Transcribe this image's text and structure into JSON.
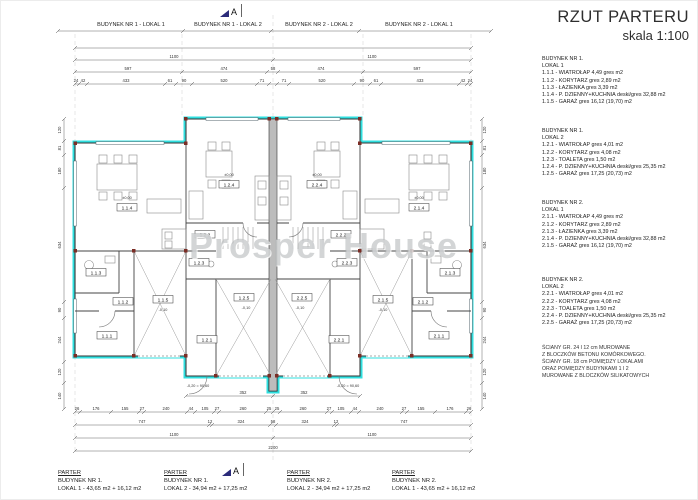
{
  "title": {
    "main": "RZUT PARTERU",
    "scale": "skala 1:100"
  },
  "section_marker": "A",
  "watermark": "Prosper House",
  "top_labels": [
    "BUDYNEK NR 1 - LOKAL 1",
    "BUDYNEK NR 1 - LOKAL 2",
    "BUDYNEK NR 2 - LOKAL 2",
    "BUDYNEK NR 2 - LOKAL 1"
  ],
  "bottom_labels": [
    {
      "title": "PARTER",
      "building": "BUDYNEK NR 1.",
      "area": "LOKAL 1 - 43,65 m2 + 16,12 m2"
    },
    {
      "title": "PARTER",
      "building": "BUDYNEK NR 1.",
      "area": "LOKAL 2 - 34,94 m2 + 17,25 m2"
    },
    {
      "title": "PARTER",
      "building": "BUDYNEK NR 2.",
      "area": "LOKAL 2 - 34,94 m2 + 17,25 m2"
    },
    {
      "title": "PARTER",
      "building": "BUDYNEK NR 2.",
      "area": "LOKAL 1 - 43,65 m2 + 16,12 m2"
    }
  ],
  "legend": {
    "blocks": [
      {
        "building": "BUDYNEK NR 1.",
        "lokal": "LOKAL 1",
        "items": [
          "1.1.1 - WIATROŁAP 4,49 gres m2",
          "1.1.2 - KORYTARZ gres 2,89 m2",
          "1.1.3 - ŁAZIENKA gres 3,39 m2",
          "1.1.4 - P. DZIENNY+KUCHNIA deski/gres 32,88 m2",
          "1.1.5 - GARAŻ gres 16,12 (19,70) m2"
        ]
      },
      {
        "building": "BUDYNEK NR 1.",
        "lokal": "LOKAL 2",
        "items": [
          "1.2.1 - WIATROŁAP gres 4,01 m2",
          "1.2.2 - KORYTARZ gres 4,08 m2",
          "1.2.3 - TOALETA gres 1,50 m2",
          "1.2.4 - P. DZIENNY+KUCHNIA deski/gres 25,35 m2",
          "1.2.5 - GARAŻ gres 17,25 (20,73) m2"
        ]
      },
      {
        "building": "BUDYNEK NR 2.",
        "lokal": "LOKAL 1",
        "items": [
          "2.1.1 - WIATROŁAP 4,49 gres m2",
          "2.1.2 - KORYTARZ gres 2,89 m2",
          "2.1.3 - ŁAZIENKA gres 3,39 m2",
          "2.1.4 - P. DZIENNY+KUCHNIA deski/gres 32,88 m2",
          "2.1.5 - GARAŻ gres 16,12 (19,70) m2"
        ]
      },
      {
        "building": "BUDYNEK NR 2.",
        "lokal": "LOKAL 2",
        "items": [
          "2.2.1 - WIATROŁAP gres 4,01 m2",
          "2.2.2 - KORYTARZ gres 4,08 m2",
          "2.2.3 - TOALETA gres 1,50 m2",
          "2.2.4 - P. DZIENNY+KUCHNIA deski/gres 25,35 m2",
          "2.2.5 - GARAŻ gres 17,25 (20,73) m2"
        ]
      }
    ],
    "note": [
      "ŚCIANY GR. 24 I 12 cm MUROWANE",
      "Z BLOCZKÓW BETONU KOMÓRKOWEGO.",
      "ŚCIANY GR. 18 cm POMIĘDZY LOKALAMI",
      "ORAZ POMIĘDZY BUDYNKAMI 1 I 2",
      "MUROWANE Z BLOCZKÓW SILIKATOWYCH"
    ]
  },
  "plan": {
    "colors": {
      "insulation": "#2fdfdf",
      "marker": "#7b2d25",
      "section": "#2b2b7a"
    },
    "rooms": [
      {
        "tr": "translate(126,208)",
        "t": "1.1.4"
      },
      {
        "tr": "translate(228,185)",
        "t": "1.2.4"
      },
      {
        "tr": "translate(316,185)",
        "t": "2.2.4"
      },
      {
        "tr": "translate(418,208)",
        "t": "2.1.4"
      },
      {
        "tr": "translate(95,273)",
        "t": "1.1.3"
      },
      {
        "tr": "translate(122,302)",
        "t": "1.1.2"
      },
      {
        "tr": "translate(106,336)",
        "t": "1.1.1"
      },
      {
        "tr": "translate(162,300)",
        "t": "1.1.5"
      },
      {
        "tr": "translate(204,235)",
        "t": "1.2.2"
      },
      {
        "tr": "translate(198,263)",
        "t": "1.2.3"
      },
      {
        "tr": "translate(243,298)",
        "t": "1.2.5"
      },
      {
        "tr": "translate(206,340)",
        "t": "1.2.1"
      },
      {
        "tr": "translate(340,235)",
        "t": "2.2.2"
      },
      {
        "tr": "translate(346,263)",
        "t": "2.2.3"
      },
      {
        "tr": "translate(301,298)",
        "t": "2.2.5"
      },
      {
        "tr": "translate(338,340)",
        "t": "2.2.1"
      },
      {
        "tr": "translate(449,273)",
        "t": "2.1.3"
      },
      {
        "tr": "translate(422,302)",
        "t": "2.1.2"
      },
      {
        "tr": "translate(438,336)",
        "t": "2.1.1"
      },
      {
        "tr": "translate(382,300)",
        "t": "2.1.5"
      }
    ],
    "levels": [
      {
        "tr": "translate(126,198)",
        "t": "±0,00"
      },
      {
        "tr": "translate(228,175)",
        "t": "±0,00"
      },
      {
        "tr": "translate(316,175)",
        "t": "±0,00"
      },
      {
        "tr": "translate(418,198)",
        "t": "±0,00"
      },
      {
        "tr": "translate(162,310)",
        "t": "-0,10"
      },
      {
        "tr": "translate(245,308)",
        "t": "-0,10"
      },
      {
        "tr": "translate(299,308)",
        "t": "-0,10"
      },
      {
        "tr": "translate(382,310)",
        "t": "-0,10"
      },
      {
        "tr": "translate(197,386)",
        "t": "-0,20 = 90,60"
      },
      {
        "tr": "translate(347,386)",
        "t": "-0,20 = 90,60"
      }
    ],
    "dims": {
      "top_total": [
        {
          "x": 272,
          "t": "2200"
        }
      ],
      "top_halves": [
        {
          "x": 173,
          "t": "1100"
        },
        {
          "x": 371,
          "t": "1100"
        }
      ],
      "top_seg": [
        {
          "x": 127,
          "t": "597"
        },
        {
          "x": 223,
          "t": "474"
        },
        {
          "x": 272,
          "t": "58"
        },
        {
          "x": 320,
          "t": "474"
        },
        {
          "x": 416,
          "t": "597"
        }
      ],
      "top_detail": [
        {
          "x": 75,
          "t": "24"
        },
        {
          "x": 82,
          "t": "42"
        },
        {
          "x": 125,
          "t": "433"
        },
        {
          "x": 169,
          "t": "61"
        },
        {
          "x": 183,
          "t": "90"
        },
        {
          "x": 223,
          "t": "520"
        },
        {
          "x": 261,
          "t": "71"
        },
        {
          "x": 283,
          "t": "71"
        },
        {
          "x": 321,
          "t": "520"
        },
        {
          "x": 361,
          "t": "90"
        },
        {
          "x": 375,
          "t": "61"
        },
        {
          "x": 419,
          "t": "433"
        },
        {
          "x": 462,
          "t": "42"
        },
        {
          "x": 469,
          "t": "24"
        }
      ],
      "bottom_352": [
        {
          "x": 242,
          "t": "352"
        },
        {
          "x": 303,
          "t": "352"
        }
      ],
      "bottom_detail": [
        {
          "x": 76,
          "t": "26"
        },
        {
          "x": 95,
          "t": "176"
        },
        {
          "x": 124,
          "t": "155"
        },
        {
          "x": 141,
          "t": "27"
        },
        {
          "x": 165,
          "t": "240"
        },
        {
          "x": 190,
          "t": "44"
        },
        {
          "x": 204,
          "t": "105"
        },
        {
          "x": 216,
          "t": "27"
        },
        {
          "x": 242,
          "t": "260"
        },
        {
          "x": 268,
          "t": "25"
        },
        {
          "x": 276,
          "t": "25"
        },
        {
          "x": 302,
          "t": "260"
        },
        {
          "x": 328,
          "t": "27"
        },
        {
          "x": 340,
          "t": "105"
        },
        {
          "x": 354,
          "t": "44"
        },
        {
          "x": 379,
          "t": "240"
        },
        {
          "x": 403,
          "t": "27"
        },
        {
          "x": 420,
          "t": "155"
        },
        {
          "x": 449,
          "t": "176"
        },
        {
          "x": 468,
          "t": "26"
        }
      ],
      "bottom_mid": [
        {
          "x": 141,
          "t": "747"
        },
        {
          "x": 209,
          "t": "12"
        },
        {
          "x": 240,
          "t": "324"
        },
        {
          "x": 272,
          "t": "58"
        },
        {
          "x": 304,
          "t": "324"
        },
        {
          "x": 335,
          "t": "12"
        },
        {
          "x": 403,
          "t": "747"
        }
      ],
      "bottom_halves": [
        {
          "x": 173,
          "t": "1100"
        },
        {
          "x": 371,
          "t": "1100"
        }
      ],
      "bottom_total": [
        {
          "x": 272,
          "t": "2200"
        }
      ],
      "left": [
        {
          "tr": "translate(60,129) rotate(-90)",
          "t": "120"
        },
        {
          "tr": "translate(60,147) rotate(-90)",
          "t": "81"
        },
        {
          "tr": "translate(60,170) rotate(-90)",
          "t": "180"
        },
        {
          "tr": "translate(60,244) rotate(-90)",
          "t": "634"
        },
        {
          "tr": "translate(60,309) rotate(-90)",
          "t": "90"
        },
        {
          "tr": "translate(60,339) rotate(-90)",
          "t": "244"
        },
        {
          "tr": "translate(60,371) rotate(-90)",
          "t": "120"
        },
        {
          "tr": "translate(60,395) rotate(-90)",
          "t": "140"
        }
      ],
      "right": [
        {
          "tr": "translate(485,129) rotate(-90)",
          "t": "120"
        },
        {
          "tr": "translate(485,147) rotate(-90)",
          "t": "81"
        },
        {
          "tr": "translate(485,170) rotate(-90)",
          "t": "180"
        },
        {
          "tr": "translate(485,244) rotate(-90)",
          "t": "634"
        },
        {
          "tr": "translate(485,309) rotate(-90)",
          "t": "90"
        },
        {
          "tr": "translate(485,339) rotate(-90)",
          "t": "244"
        },
        {
          "tr": "translate(485,371) rotate(-90)",
          "t": "120"
        },
        {
          "tr": "translate(485,395) rotate(-90)",
          "t": "140"
        }
      ]
    }
  }
}
